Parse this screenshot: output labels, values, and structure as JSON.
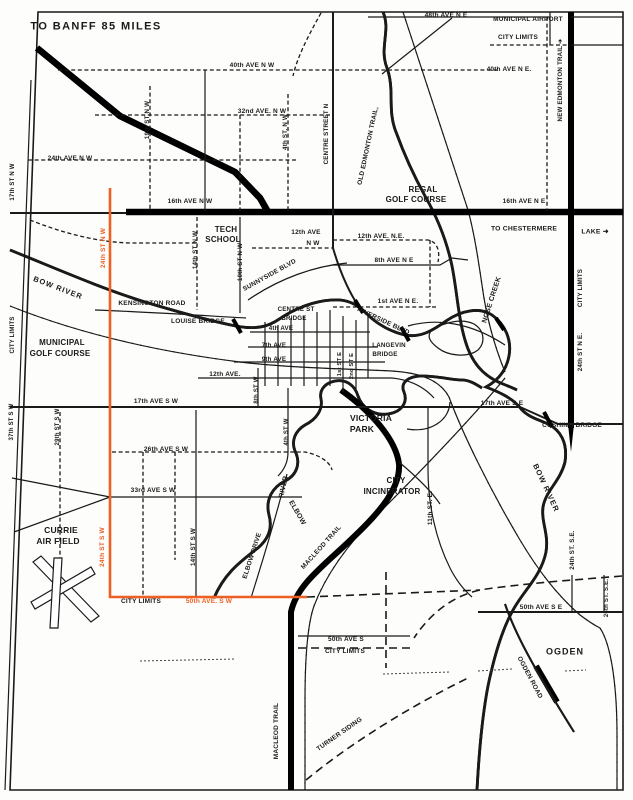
{
  "map": {
    "title": "TO BANFF 85 MILES",
    "colors": {
      "ink": "#1a1a1a",
      "highlight_route": "#ee5f24",
      "paper": "#fdfdfc"
    },
    "labels": [
      {
        "id": "to-banff",
        "text": "TO BANFF 85 MILES",
        "x": 96,
        "y": 27,
        "size": 11,
        "ls": 1.4
      },
      {
        "id": "48th-ave-ne",
        "text": "48th AVE N E",
        "x": 446,
        "y": 16,
        "size": 6.5
      },
      {
        "id": "municipal-airport",
        "text": "MUNICIPAL AIRPORT",
        "x": 528,
        "y": 20,
        "size": 6.5
      },
      {
        "id": "city-limits-airport",
        "text": "CITY LIMITS",
        "x": 518,
        "y": 38,
        "size": 6.5
      },
      {
        "id": "40th-ave-nw",
        "text": "40th AVE N W",
        "x": 252,
        "y": 66,
        "size": 6.5
      },
      {
        "id": "40th-ave-ne",
        "text": "40th AVE N E.",
        "x": 509,
        "y": 70,
        "size": 6.5
      },
      {
        "id": "32nd-ave-nw",
        "text": "32nd AVE. N W",
        "x": 262,
        "y": 112,
        "size": 6.5
      },
      {
        "id": "24th-ave-nw",
        "text": "24th AVE N W",
        "x": 70,
        "y": 159,
        "size": 6.5
      },
      {
        "id": "16th-ave-nw",
        "text": "16th AVE N W",
        "x": 190,
        "y": 202,
        "size": 6.5
      },
      {
        "id": "16th-ave-ne",
        "text": "16th AVE N E",
        "x": 524,
        "y": 202,
        "size": 6.5
      },
      {
        "id": "19th-st-nw",
        "text": "19th ST N W",
        "x": 148,
        "y": 120,
        "rot": -90,
        "size": 6.2
      },
      {
        "id": "4th-st-nw",
        "text": "4th ST. N W",
        "x": 286,
        "y": 132,
        "rot": -90,
        "size": 6.2
      },
      {
        "id": "17th-st-nw",
        "text": "17th ST N W",
        "x": 13,
        "y": 182,
        "rot": -90,
        "size": 6
      },
      {
        "id": "new-edmonton-trail",
        "text": "NEW EDMONTON TRAIL ➔",
        "x": 561,
        "y": 80,
        "rot": -90,
        "size": 6.2
      },
      {
        "id": "old-edmonton-trail",
        "text": "OLD EDMONTON TRAIL,",
        "x": 369,
        "y": 146,
        "rot": -78,
        "size": 6.5
      },
      {
        "id": "centre-street-n",
        "text": "CENTRE STREET N",
        "x": 327,
        "y": 134,
        "rot": -90,
        "size": 6.2
      },
      {
        "id": "regal-golf-1",
        "text": "REGAL",
        "x": 423,
        "y": 190,
        "size": 8
      },
      {
        "id": "regal-golf-2",
        "text": "GOLF COURSE",
        "x": 416,
        "y": 200,
        "size": 8
      },
      {
        "id": "tech-school-1",
        "text": "TECH",
        "x": 226,
        "y": 230,
        "size": 8
      },
      {
        "id": "tech-school-2",
        "text": "SCHOOL",
        "x": 223,
        "y": 240,
        "size": 8
      },
      {
        "id": "12th-ave-nw-1",
        "text": "12th AVE",
        "x": 306,
        "y": 233,
        "size": 6.5
      },
      {
        "id": "12th-ave-nw-2",
        "text": "N W",
        "x": 313,
        "y": 244,
        "size": 6.5
      },
      {
        "id": "12th-ave-ne",
        "text": "12th AVE. N.E.",
        "x": 381,
        "y": 237,
        "size": 6.5
      },
      {
        "id": "8th-ave-ne",
        "text": "8th AVE N E",
        "x": 394,
        "y": 261,
        "size": 6.5
      },
      {
        "id": "1st-ave-ne",
        "text": "1st AVE N E.",
        "x": 398,
        "y": 302,
        "size": 6.5
      },
      {
        "id": "to-chestermere",
        "text": "TO CHESTERMERE",
        "x": 524,
        "y": 230,
        "size": 6.8
      },
      {
        "id": "lake",
        "text": "LAKE ➜",
        "x": 595,
        "y": 233,
        "size": 6.8
      },
      {
        "id": "nose-creek",
        "text": "NOSE CREEK",
        "x": 492,
        "y": 300,
        "rot": -72,
        "size": 7
      },
      {
        "id": "city-limits-ne",
        "text": "CITY LIMITS",
        "x": 581,
        "y": 288,
        "rot": -90,
        "size": 6.2
      },
      {
        "id": "24th-st-ne",
        "text": "24th ST N E.",
        "x": 581,
        "y": 352,
        "rot": -90,
        "size": 6.2
      },
      {
        "id": "14th-st-nw",
        "text": "14th ST N W",
        "x": 196,
        "y": 250,
        "rot": -90,
        "size": 6.2
      },
      {
        "id": "10th-st-nw",
        "text": "10th ST N W",
        "x": 241,
        "y": 262,
        "rot": -90,
        "size": 6.2
      },
      {
        "id": "24th-st-nw",
        "text": "24th ST  N W",
        "x": 104,
        "y": 248,
        "rot": -90,
        "size": 6.5,
        "color": "#ee5f24"
      },
      {
        "id": "sunnyside-blvd",
        "text": "SUNNYSIDE BLVD",
        "x": 270,
        "y": 276,
        "rot": -29,
        "size": 6.5
      },
      {
        "id": "kensington-road",
        "text": "KENSINGTON ROAD",
        "x": 152,
        "y": 304,
        "size": 6.5
      },
      {
        "id": "louise-bridge",
        "text": "LOUISE BRIDGE",
        "x": 198,
        "y": 322,
        "size": 6.5
      },
      {
        "id": "centre-st-bridge-1",
        "text": "CENTRE ST",
        "x": 296,
        "y": 310,
        "size": 6.2
      },
      {
        "id": "centre-st-bridge-2",
        "text": "BRIDGE",
        "x": 294,
        "y": 319,
        "size": 6.2
      },
      {
        "id": "4th-ave",
        "text": "4th AVE",
        "x": 281,
        "y": 329,
        "size": 6.2
      },
      {
        "id": "riverside-blvd",
        "text": "RIVERSIDE BLVD",
        "x": 383,
        "y": 322,
        "rot": 25,
        "size": 6.5
      },
      {
        "id": "langevin-bridge-1",
        "text": "LANGEVIN",
        "x": 389,
        "y": 346,
        "size": 6.2
      },
      {
        "id": "langevin-bridge-2",
        "text": "BRIDGE",
        "x": 385,
        "y": 355,
        "size": 6.2
      },
      {
        "id": "bow-river-w",
        "text": "BOW RIVER",
        "x": 58,
        "y": 288,
        "rot": 21,
        "size": 7.5,
        "ls": 1
      },
      {
        "id": "municipal-golf-1",
        "text": "MUNICIPAL",
        "x": 62,
        "y": 343,
        "size": 8
      },
      {
        "id": "municipal-golf-2",
        "text": "GOLF COURSE",
        "x": 60,
        "y": 354,
        "size": 8
      },
      {
        "id": "city-limits-w",
        "text": "CITY LIMITS",
        "x": 13,
        "y": 335,
        "rot": -90,
        "size": 6
      },
      {
        "id": "7th-ave",
        "text": "7th AVE",
        "x": 274,
        "y": 346,
        "size": 6.2
      },
      {
        "id": "9th-ave",
        "text": "9th AVE",
        "x": 274,
        "y": 360,
        "size": 6.2
      },
      {
        "id": "12th-ave",
        "text": "12th AVE.",
        "x": 225,
        "y": 375,
        "size": 6.5
      },
      {
        "id": "8th-st-w",
        "text": "8th ST W",
        "x": 257,
        "y": 390,
        "rot": -90,
        "size": 6
      },
      {
        "id": "1st-st-e",
        "text": "1st ST E",
        "x": 341,
        "y": 364,
        "rot": -90,
        "size": 5.8
      },
      {
        "id": "2nd-st-e",
        "text": "2nd ST E",
        "x": 353,
        "y": 366,
        "rot": -90,
        "size": 5.8
      },
      {
        "id": "17th-ave-sw",
        "text": "17th AVE S W",
        "x": 156,
        "y": 402,
        "size": 6.5
      },
      {
        "id": "17th-ave-se",
        "text": "17th AVE S E",
        "x": 502,
        "y": 404,
        "size": 6.5
      },
      {
        "id": "cushing-bridge",
        "text": "CUSHING BRIDGE",
        "x": 572,
        "y": 426,
        "size": 6.5
      },
      {
        "id": "victoria-park-1",
        "text": "VICTORIA",
        "x": 371,
        "y": 418,
        "size": 8.5
      },
      {
        "id": "victoria-park-2",
        "text": "PARK",
        "x": 362,
        "y": 429,
        "size": 8.5
      },
      {
        "id": "37th-st-sw",
        "text": "37th ST S W",
        "x": 12,
        "y": 422,
        "rot": -90,
        "size": 6
      },
      {
        "id": "29th-st-sw",
        "text": "29th ST S W",
        "x": 58,
        "y": 427,
        "rot": -90,
        "size": 6
      },
      {
        "id": "26th-ave-sw",
        "text": "26th AVE S W",
        "x": 166,
        "y": 450,
        "size": 6.5
      },
      {
        "id": "4th-st-w",
        "text": "4th ST W",
        "x": 287,
        "y": 432,
        "rot": -90,
        "size": 6
      },
      {
        "id": "city-incinerator-1",
        "text": "CITY",
        "x": 396,
        "y": 481,
        "size": 8
      },
      {
        "id": "city-incinerator-2",
        "text": "INCINERATOR",
        "x": 392,
        "y": 492,
        "size": 8
      },
      {
        "id": "33rd-ave-sw",
        "text": "33rd AVE S W",
        "x": 153,
        "y": 491,
        "size": 6.5
      },
      {
        "id": "currie-1",
        "text": "CURRIE",
        "x": 61,
        "y": 530,
        "size": 8.5
      },
      {
        "id": "currie-2",
        "text": "AIR FIELD",
        "x": 58,
        "y": 541,
        "size": 8.5
      },
      {
        "id": "24th-st-sw",
        "text": "24th ST S W",
        "x": 103,
        "y": 547,
        "rot": -90,
        "size": 6.5,
        "color": "#ee5f24"
      },
      {
        "id": "14th-st-sw",
        "text": "14th ST S W",
        "x": 194,
        "y": 547,
        "rot": -90,
        "size": 6.2
      },
      {
        "id": "elbow-river-1",
        "text": "RIVER",
        "x": 284,
        "y": 487,
        "rot": -78,
        "size": 7
      },
      {
        "id": "elbow-river-2",
        "text": "ELBOW",
        "x": 297,
        "y": 513,
        "rot": 60,
        "size": 7
      },
      {
        "id": "elbow-drive",
        "text": "ELBOW DRIVE",
        "x": 253,
        "y": 556,
        "rot": -72,
        "size": 6.5
      },
      {
        "id": "macleod-trail-diag",
        "text": "MACLEOD TRAIL",
        "x": 322,
        "y": 548,
        "rot": -48,
        "size": 6.5
      },
      {
        "id": "11th-st-e",
        "text": "11th ST. E.",
        "x": 431,
        "y": 508,
        "rot": -90,
        "size": 6.5
      },
      {
        "id": "bow-river-e",
        "text": "BOW RIVER",
        "x": 546,
        "y": 488,
        "rot": 65,
        "size": 7.5,
        "ls": 1
      },
      {
        "id": "24th-st-se",
        "text": "24th ST. S.E.",
        "x": 573,
        "y": 550,
        "rot": -90,
        "size": 6.2
      },
      {
        "id": "city-limits-sw",
        "text": "CITY LIMITS",
        "x": 141,
        "y": 602,
        "size": 6.5
      },
      {
        "id": "50th-ave-sw",
        "text": "50th AVE. S W",
        "x": 209,
        "y": 602,
        "size": 6.5,
        "color": "#ee5f24"
      },
      {
        "id": "50th-ave-s",
        "text": "50th AVE S",
        "x": 346,
        "y": 640,
        "size": 6.5
      },
      {
        "id": "city-limits-s",
        "text": "CITY LIMITS",
        "x": 345,
        "y": 652,
        "size": 6.5
      },
      {
        "id": "50th-ave-se",
        "text": "50th AVE S E",
        "x": 541,
        "y": 608,
        "size": 6.5
      },
      {
        "id": "ogden",
        "text": "OGDEN",
        "x": 565,
        "y": 652,
        "size": 9,
        "ls": 1
      },
      {
        "id": "ogden-road",
        "text": "OGDEN ROAD",
        "x": 529,
        "y": 678,
        "rot": 62,
        "size": 6.5
      },
      {
        "id": "macleod-trail-s",
        "text": "MACLEOD TRAIL",
        "x": 277,
        "y": 731,
        "rot": -90,
        "size": 6.5
      },
      {
        "id": "turner-siding",
        "text": "TURNER SIDING",
        "x": 340,
        "y": 735,
        "rot": -35,
        "size": 6.5
      },
      {
        "id": "26th-st-se",
        "text": "26th ST. S.E.",
        "x": 607,
        "y": 598,
        "rot": -90,
        "size": 6
      }
    ]
  }
}
